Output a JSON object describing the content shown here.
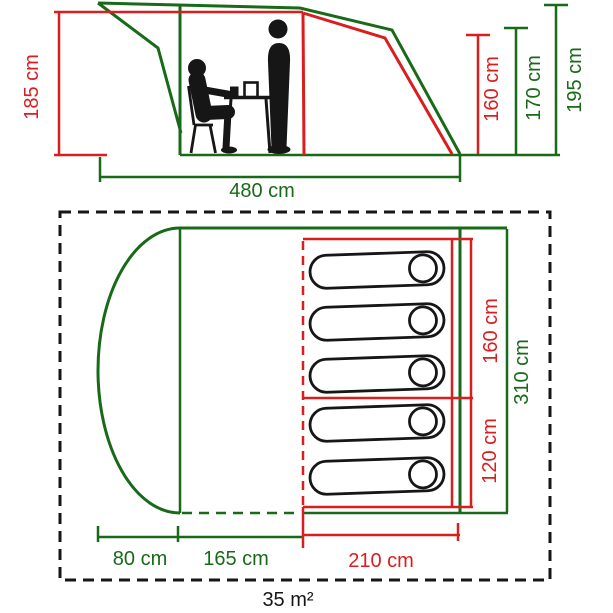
{
  "page": {
    "background": "#ffffff"
  },
  "side_view": {
    "labels": {
      "porch_height": "185 cm",
      "inner_height": "160 cm",
      "bedroom_height": "170 cm",
      "total_height": "195 cm",
      "total_length": "480 cm"
    },
    "figures": [
      "seated-person",
      "standing-person",
      "table-with-cups",
      "chair"
    ]
  },
  "floor_plan": {
    "labels": {
      "sleeping_width_main": "160 cm",
      "sleeping_width_small": "120 cm",
      "total_width": "310 cm",
      "porch_depth": "80 cm",
      "living_depth": "165 cm",
      "sleeping_depth": "210 cm",
      "floor_area": "35 m²"
    },
    "sleeping_bag_count": 5
  },
  "colors": {
    "dimension_red": "#d81e1e",
    "tent_green": "#186a18",
    "outline_black": "#161616"
  }
}
